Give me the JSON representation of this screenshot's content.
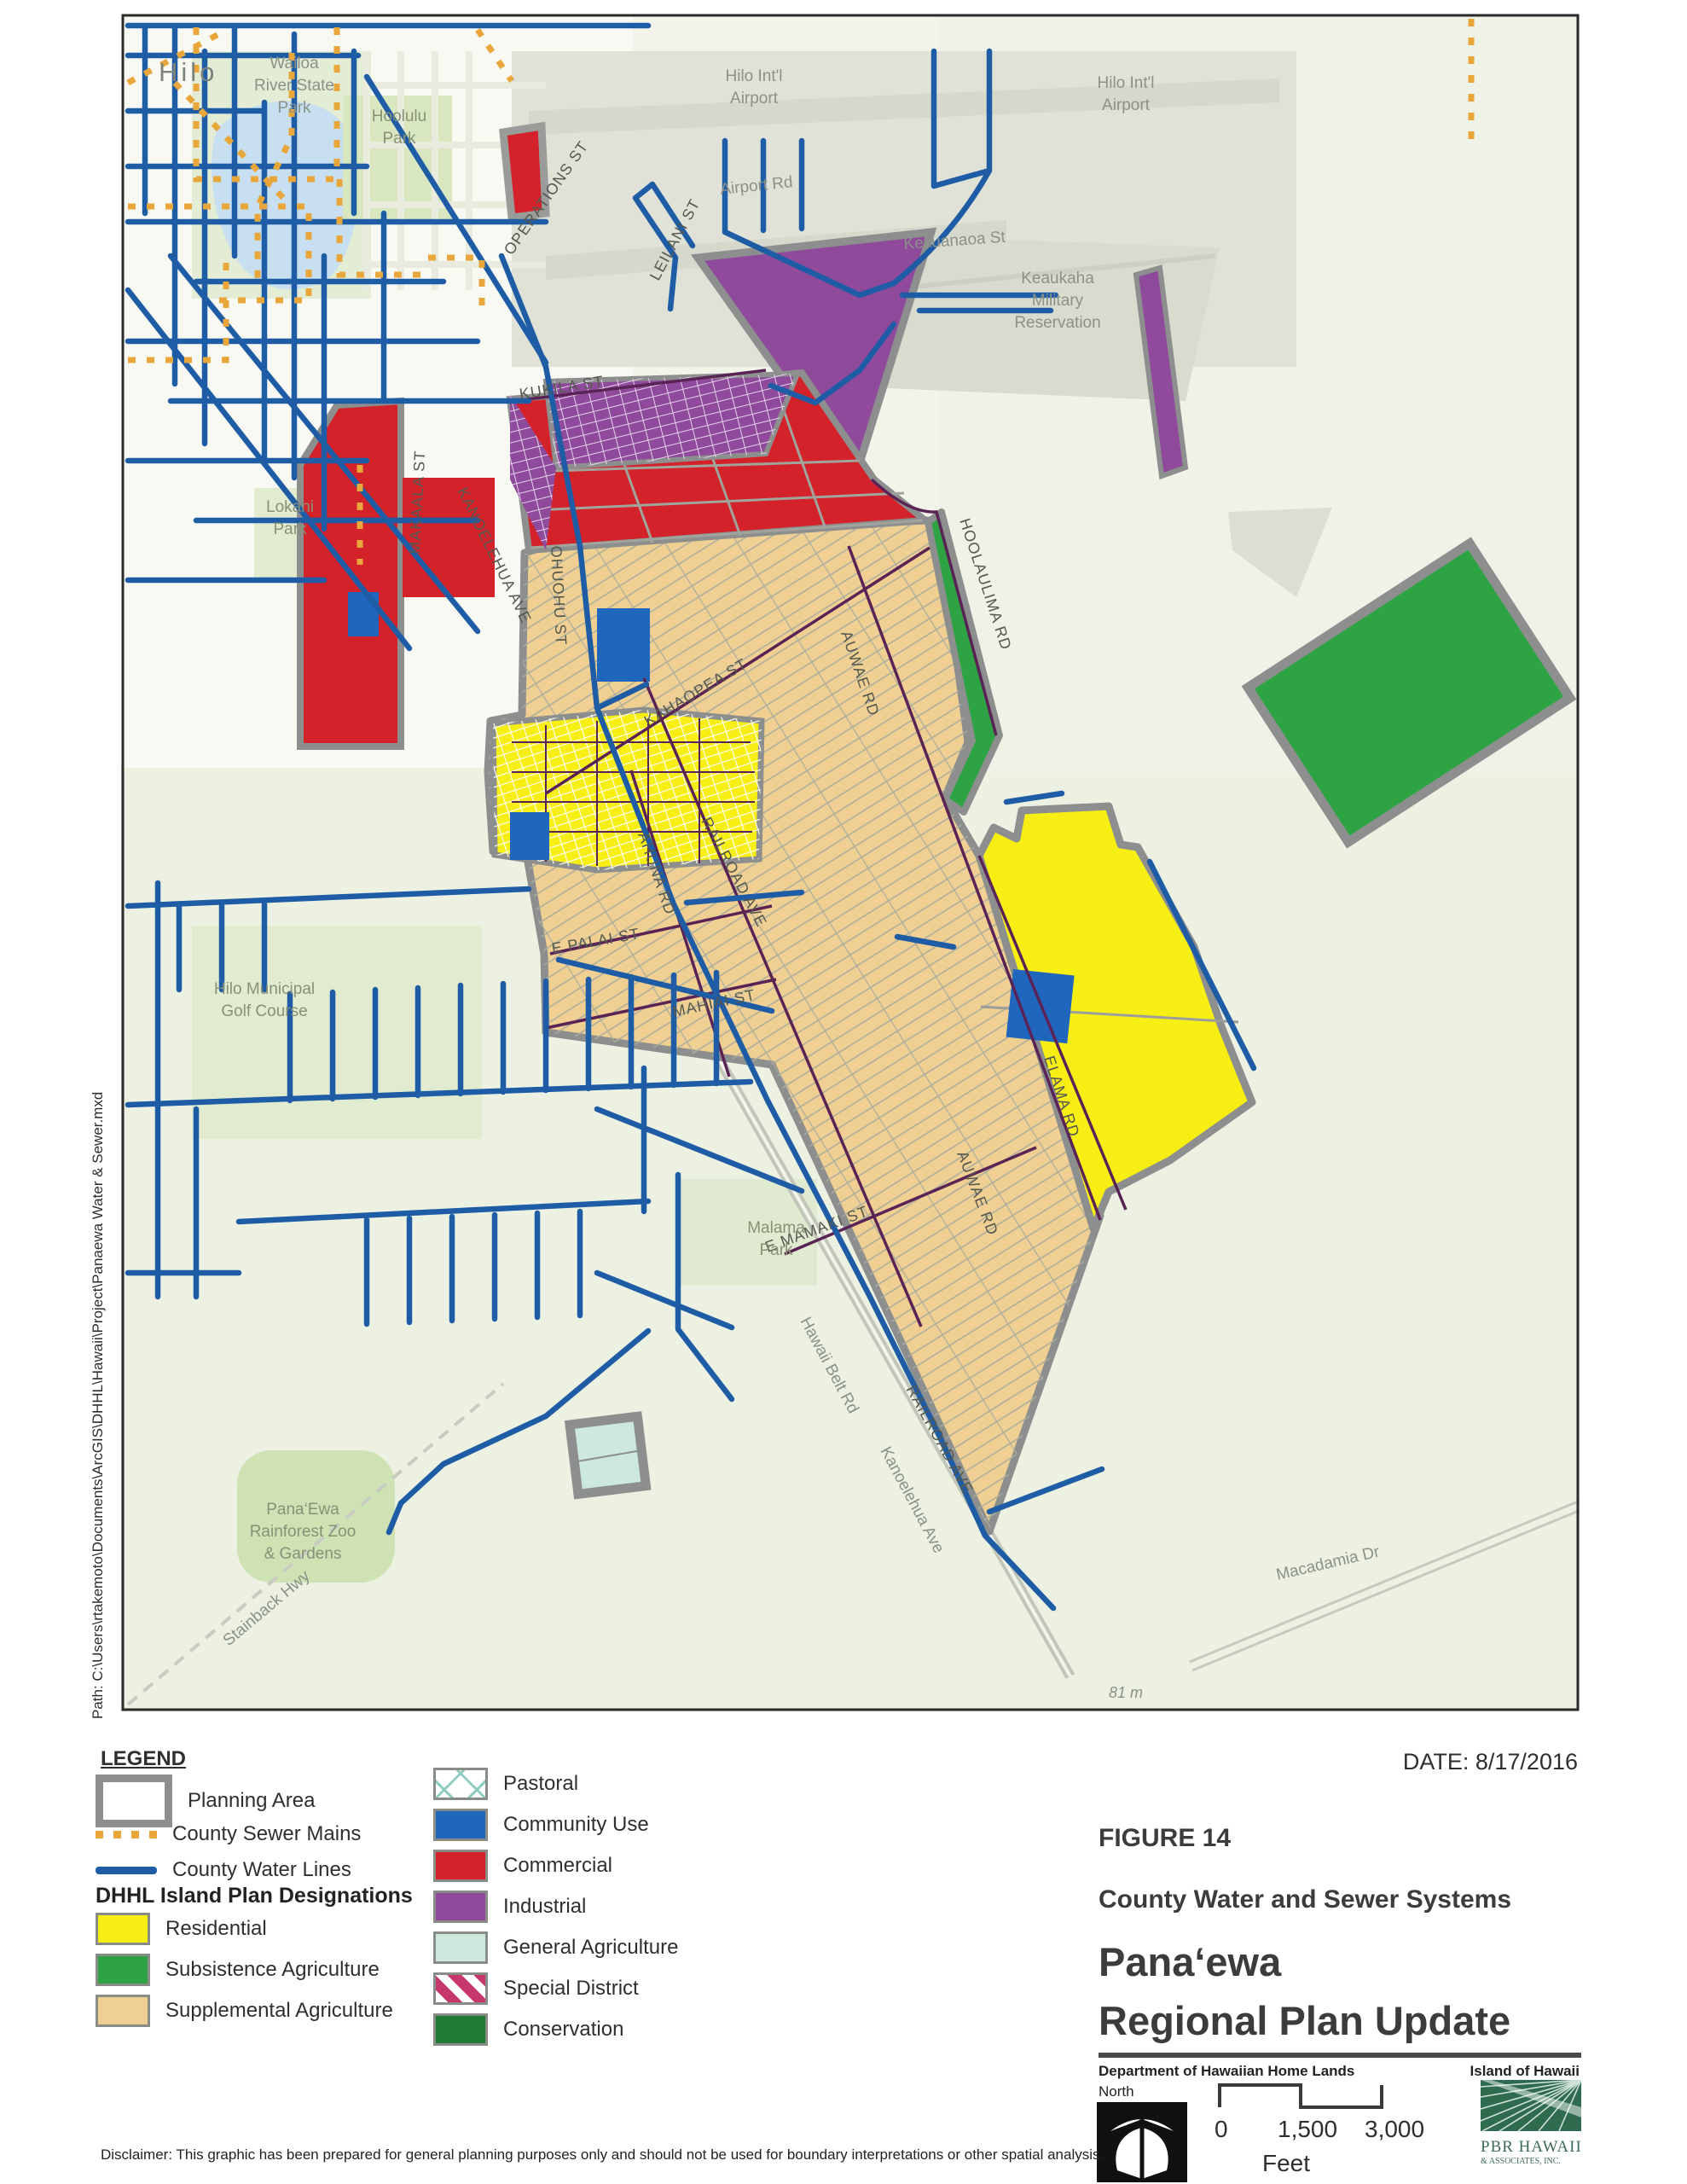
{
  "page": {
    "date_label": "DATE: 8/17/2016",
    "path_label": "Path: C:\\Users\\rtakemoto\\Documents\\ArcGIS\\DHHL\\Hawaii\\Project\\Panaewa Water & Sewer.mxd",
    "disclaimer": "Disclaimer: This graphic has been prepared for general planning purposes only and should not be used for boundary interpretations or other spatial analysis."
  },
  "figure": {
    "number": "FIGURE 14",
    "subtitle": "County Water and Sewer Systems",
    "title_line1": "Pana‘ewa",
    "title_line2": "Regional Plan Update",
    "agency": "Department of Hawaiian Home Lands",
    "north_label": "North",
    "island_label": "Island of Hawaii",
    "logo_line1": "PBR HAWAII",
    "logo_line2": "& ASSOCIATES, INC."
  },
  "scalebar": {
    "tick0": "0",
    "tick1": "1,500",
    "tick2": "3,000",
    "unit": "Feet"
  },
  "legend": {
    "title": "LEGEND",
    "designations_header": "DHHL Island Plan Designations",
    "left": [
      {
        "label": "Planning Area"
      },
      {
        "label": "County Sewer Mains"
      },
      {
        "label": "County Water Lines"
      },
      {
        "label": "Residential"
      },
      {
        "label": "Subsistence Agriculture"
      },
      {
        "label": "Supplemental Agriculture"
      }
    ],
    "right": [
      {
        "label": "Pastoral"
      },
      {
        "label": "Community Use"
      },
      {
        "label": "Commercial"
      },
      {
        "label": "Industrial"
      },
      {
        "label": "General Agriculture"
      },
      {
        "label": "Special District"
      },
      {
        "label": "Conservation"
      }
    ]
  },
  "colors": {
    "water": "#1e5ca6",
    "sewer": "#e9a73b",
    "boundary": "#8d8f8e",
    "residential": "#f7ee14",
    "subsistence": "#2da343",
    "supplemental": "#efcf92",
    "community": "#2166bd",
    "commercial": "#d3222a",
    "industrial": "#8f4a9c",
    "general_ag": "#cde9de",
    "special": "#c8376b",
    "conservation": "#1f7a33",
    "pastoral": "#8fccc0",
    "map_bg": "#f2f4ea"
  },
  "map": {
    "labels": [
      {
        "text": "Hilo"
      },
      {
        "text": "Wailoa"
      },
      {
        "text": "River State"
      },
      {
        "text": "Park"
      },
      {
        "text": "Hoolulu"
      },
      {
        "text": "Park"
      },
      {
        "text": "Hilo Int'l"
      },
      {
        "text": "Airport"
      },
      {
        "text": "Hilo Int'l"
      },
      {
        "text": "Airport"
      },
      {
        "text": "Airport Rd"
      },
      {
        "text": "LEILANI ST"
      },
      {
        "text": "OPERATIONS ST"
      },
      {
        "text": "Kekuanaoa St"
      },
      {
        "text": "Keaukaha"
      },
      {
        "text": "Military"
      },
      {
        "text": "Reservation"
      },
      {
        "text": "KUKILA ST"
      },
      {
        "text": "MAKAALA ST"
      },
      {
        "text": "KANOELEHUA AVE"
      },
      {
        "text": "OHUOHU ST"
      },
      {
        "text": "HOOLAULIMA RD"
      },
      {
        "text": "KAHAOPEA ST"
      },
      {
        "text": "AUWAE RD"
      },
      {
        "text": "RAILROAD AVE"
      },
      {
        "text": "AHUNA RD"
      },
      {
        "text": "E PALAI ST"
      },
      {
        "text": "MAHIAI ST"
      },
      {
        "text": "Hilo Municipal"
      },
      {
        "text": "Golf Course"
      },
      {
        "text": "Lokahi"
      },
      {
        "text": "Park"
      },
      {
        "text": "ELAMA RD"
      },
      {
        "text": "AUWAE RD"
      },
      {
        "text": "E MAMAKI ST"
      },
      {
        "text": "RAILROAD AVE"
      },
      {
        "text": "Malama"
      },
      {
        "text": "Park"
      },
      {
        "text": "Pana‘Ewa"
      },
      {
        "text": "Rainforest Zoo"
      },
      {
        "text": "& Gardens"
      },
      {
        "text": "Stainback Hwy"
      },
      {
        "text": "Kanoelehua Ave"
      },
      {
        "text": "Hawaii Belt Rd"
      },
      {
        "text": "Macadamia Dr"
      },
      {
        "text": "81 m"
      }
    ]
  }
}
